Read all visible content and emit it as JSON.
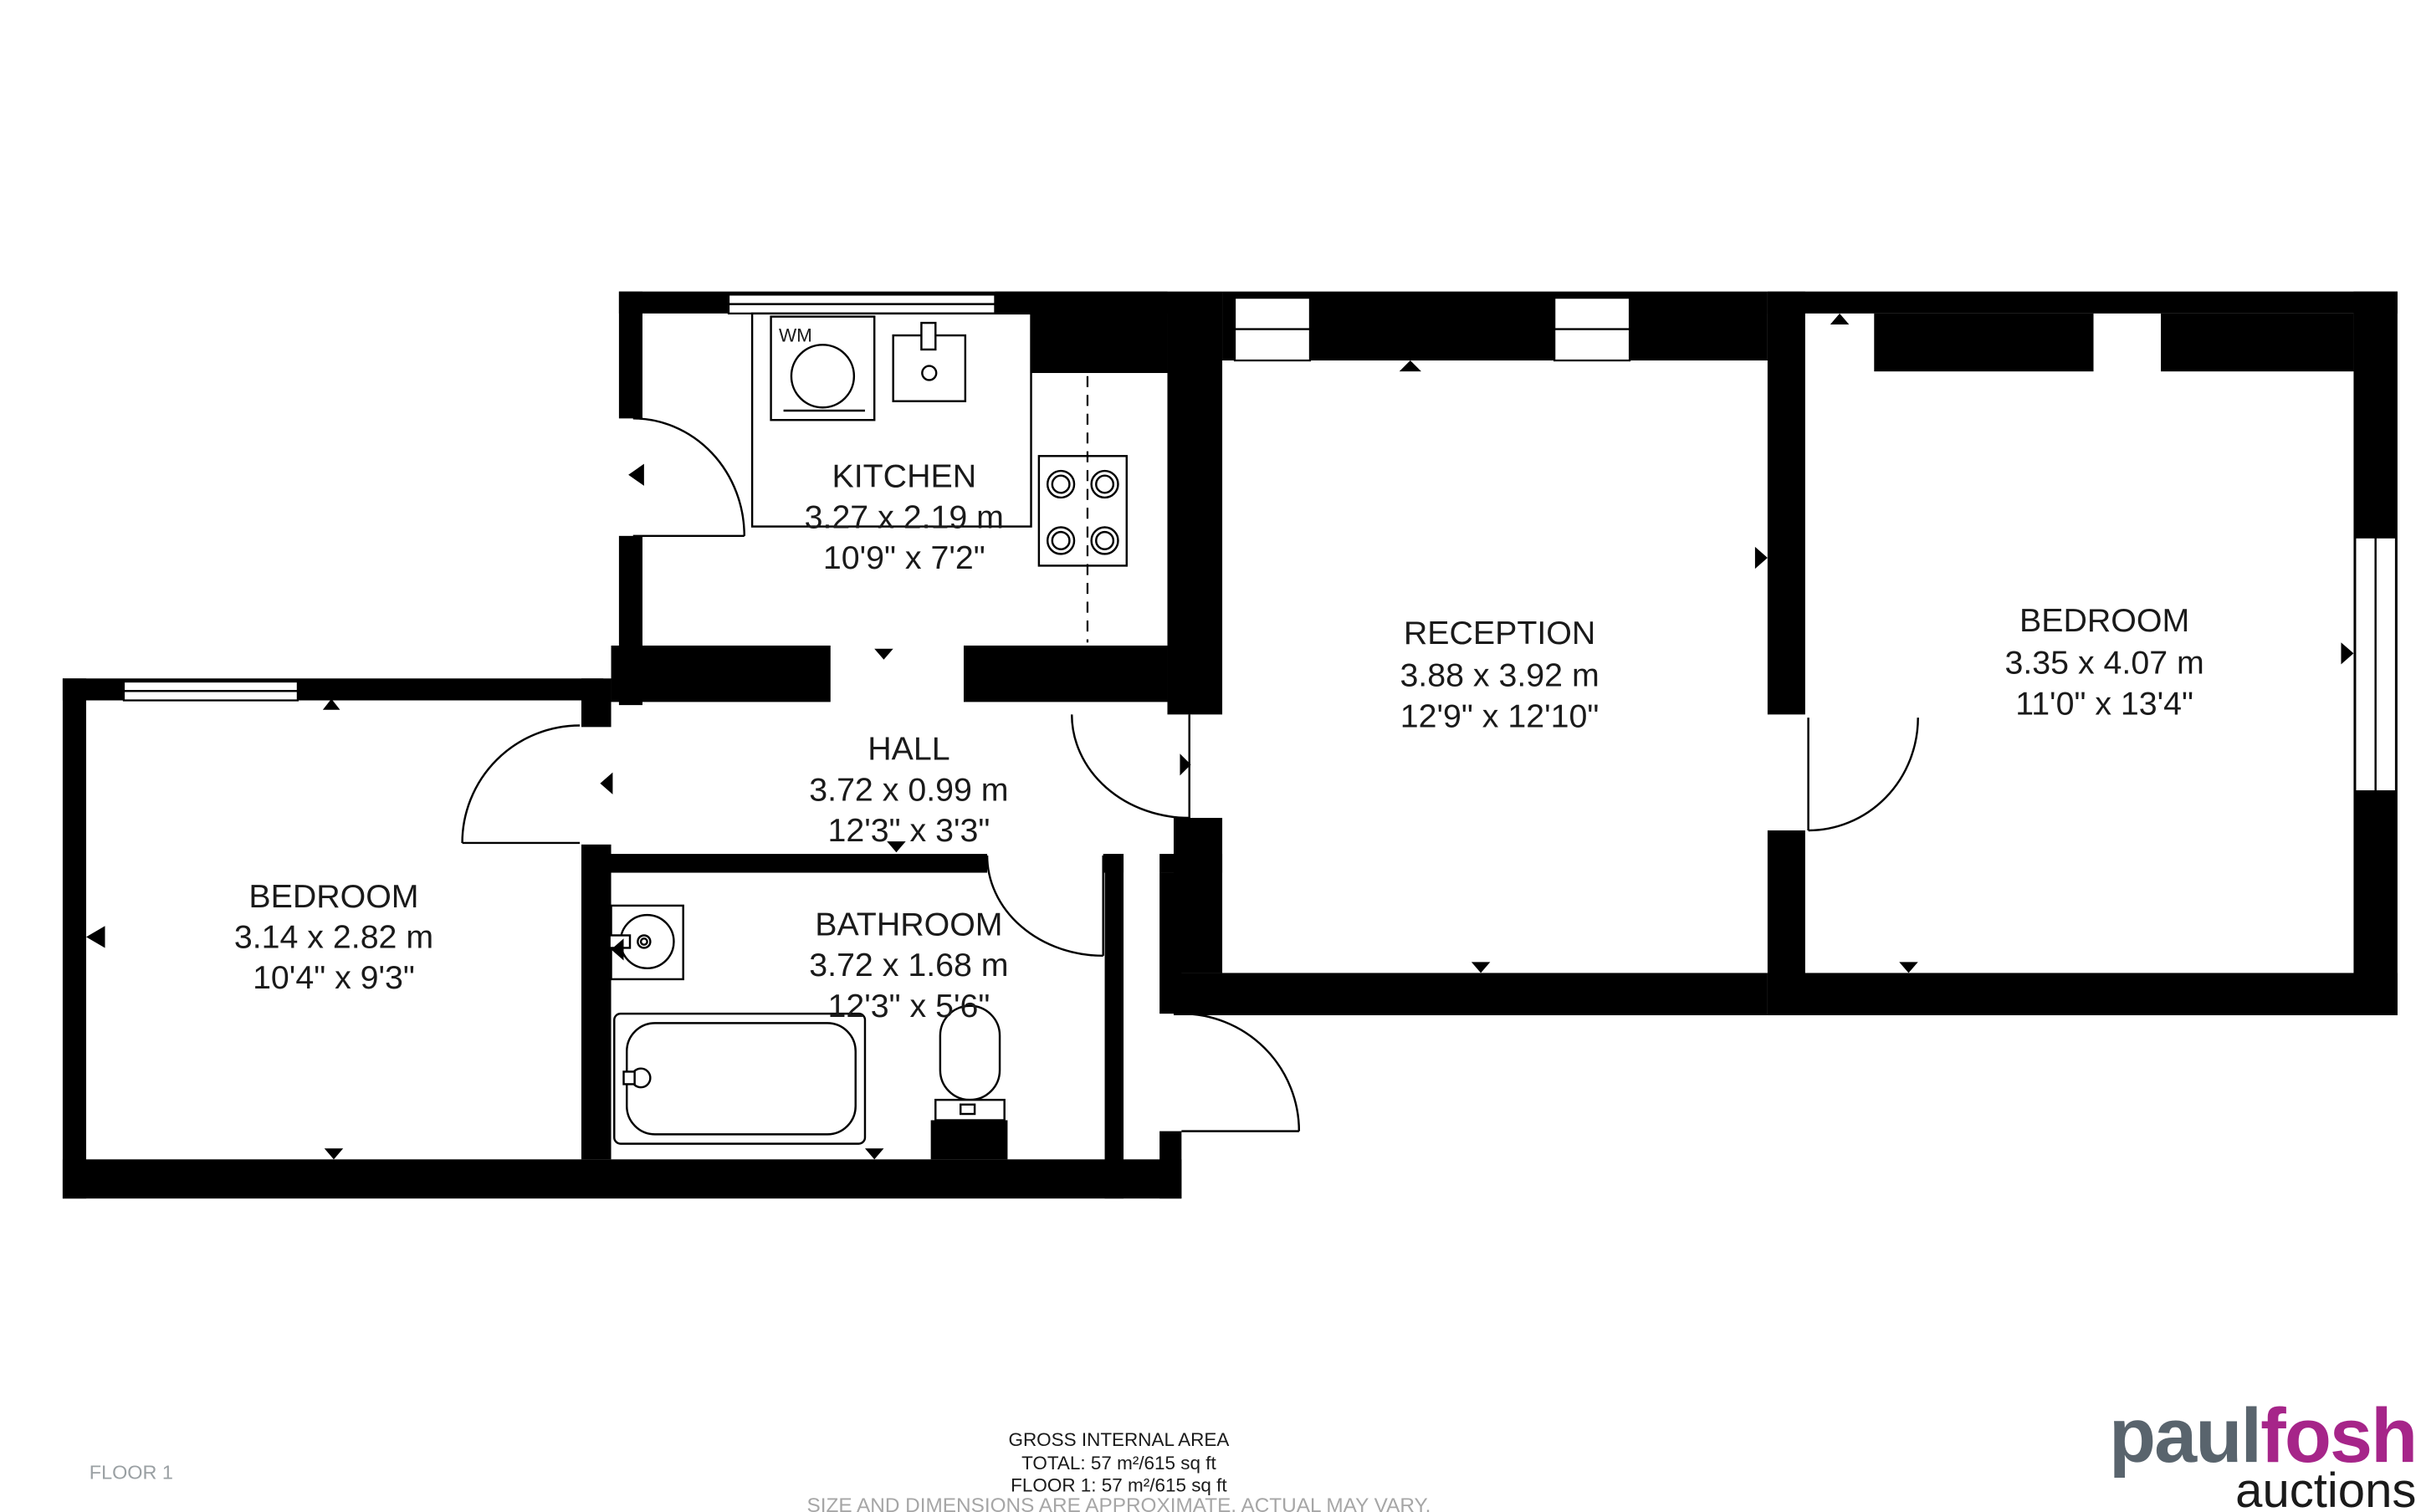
{
  "floor_label": "FLOOR 1",
  "rooms": {
    "kitchen": {
      "name": "KITCHEN",
      "metric": "3.27 x 2.19 m",
      "imperial": "10'9\" x 7'2\""
    },
    "hall": {
      "name": "HALL",
      "metric": "3.72 x 0.99 m",
      "imperial": "12'3\" x 3'3\""
    },
    "bathroom": {
      "name": "BATHROOM",
      "metric": "3.72 x 1.68 m",
      "imperial": "12'3\" x 5'6\""
    },
    "bedroom_left": {
      "name": "BEDROOM",
      "metric": "3.14 x 2.82 m",
      "imperial": "10'4\" x 9'3\""
    },
    "reception": {
      "name": "RECEPTION",
      "metric": "3.88 x 3.92 m",
      "imperial": "12'9\" x 12'10\""
    },
    "bedroom_right": {
      "name": "BEDROOM",
      "metric": "3.35 x 4.07 m",
      "imperial": "11'0\" x 13'4\""
    }
  },
  "appliances": {
    "washing_machine_label": "WM"
  },
  "footer": {
    "title": "GROSS INTERNAL AREA",
    "total": "TOTAL: 57 m²/615 sq ft",
    "floor": "FLOOR 1: 57 m²/615 sq ft",
    "disclaimer": "SIZE AND DIMENSIONS ARE APPROXIMATE, ACTUAL MAY VARY."
  },
  "logo": {
    "part1": "paul",
    "part2": "fosh",
    "part3": "auctions",
    "color_part1": "#59646d",
    "color_part2": "#a62589",
    "color_part3": "#8c2482"
  },
  "colors": {
    "wall": "#000000",
    "background": "#ffffff",
    "text": "#1a1a1a",
    "muted": "#a6a6a6"
  }
}
